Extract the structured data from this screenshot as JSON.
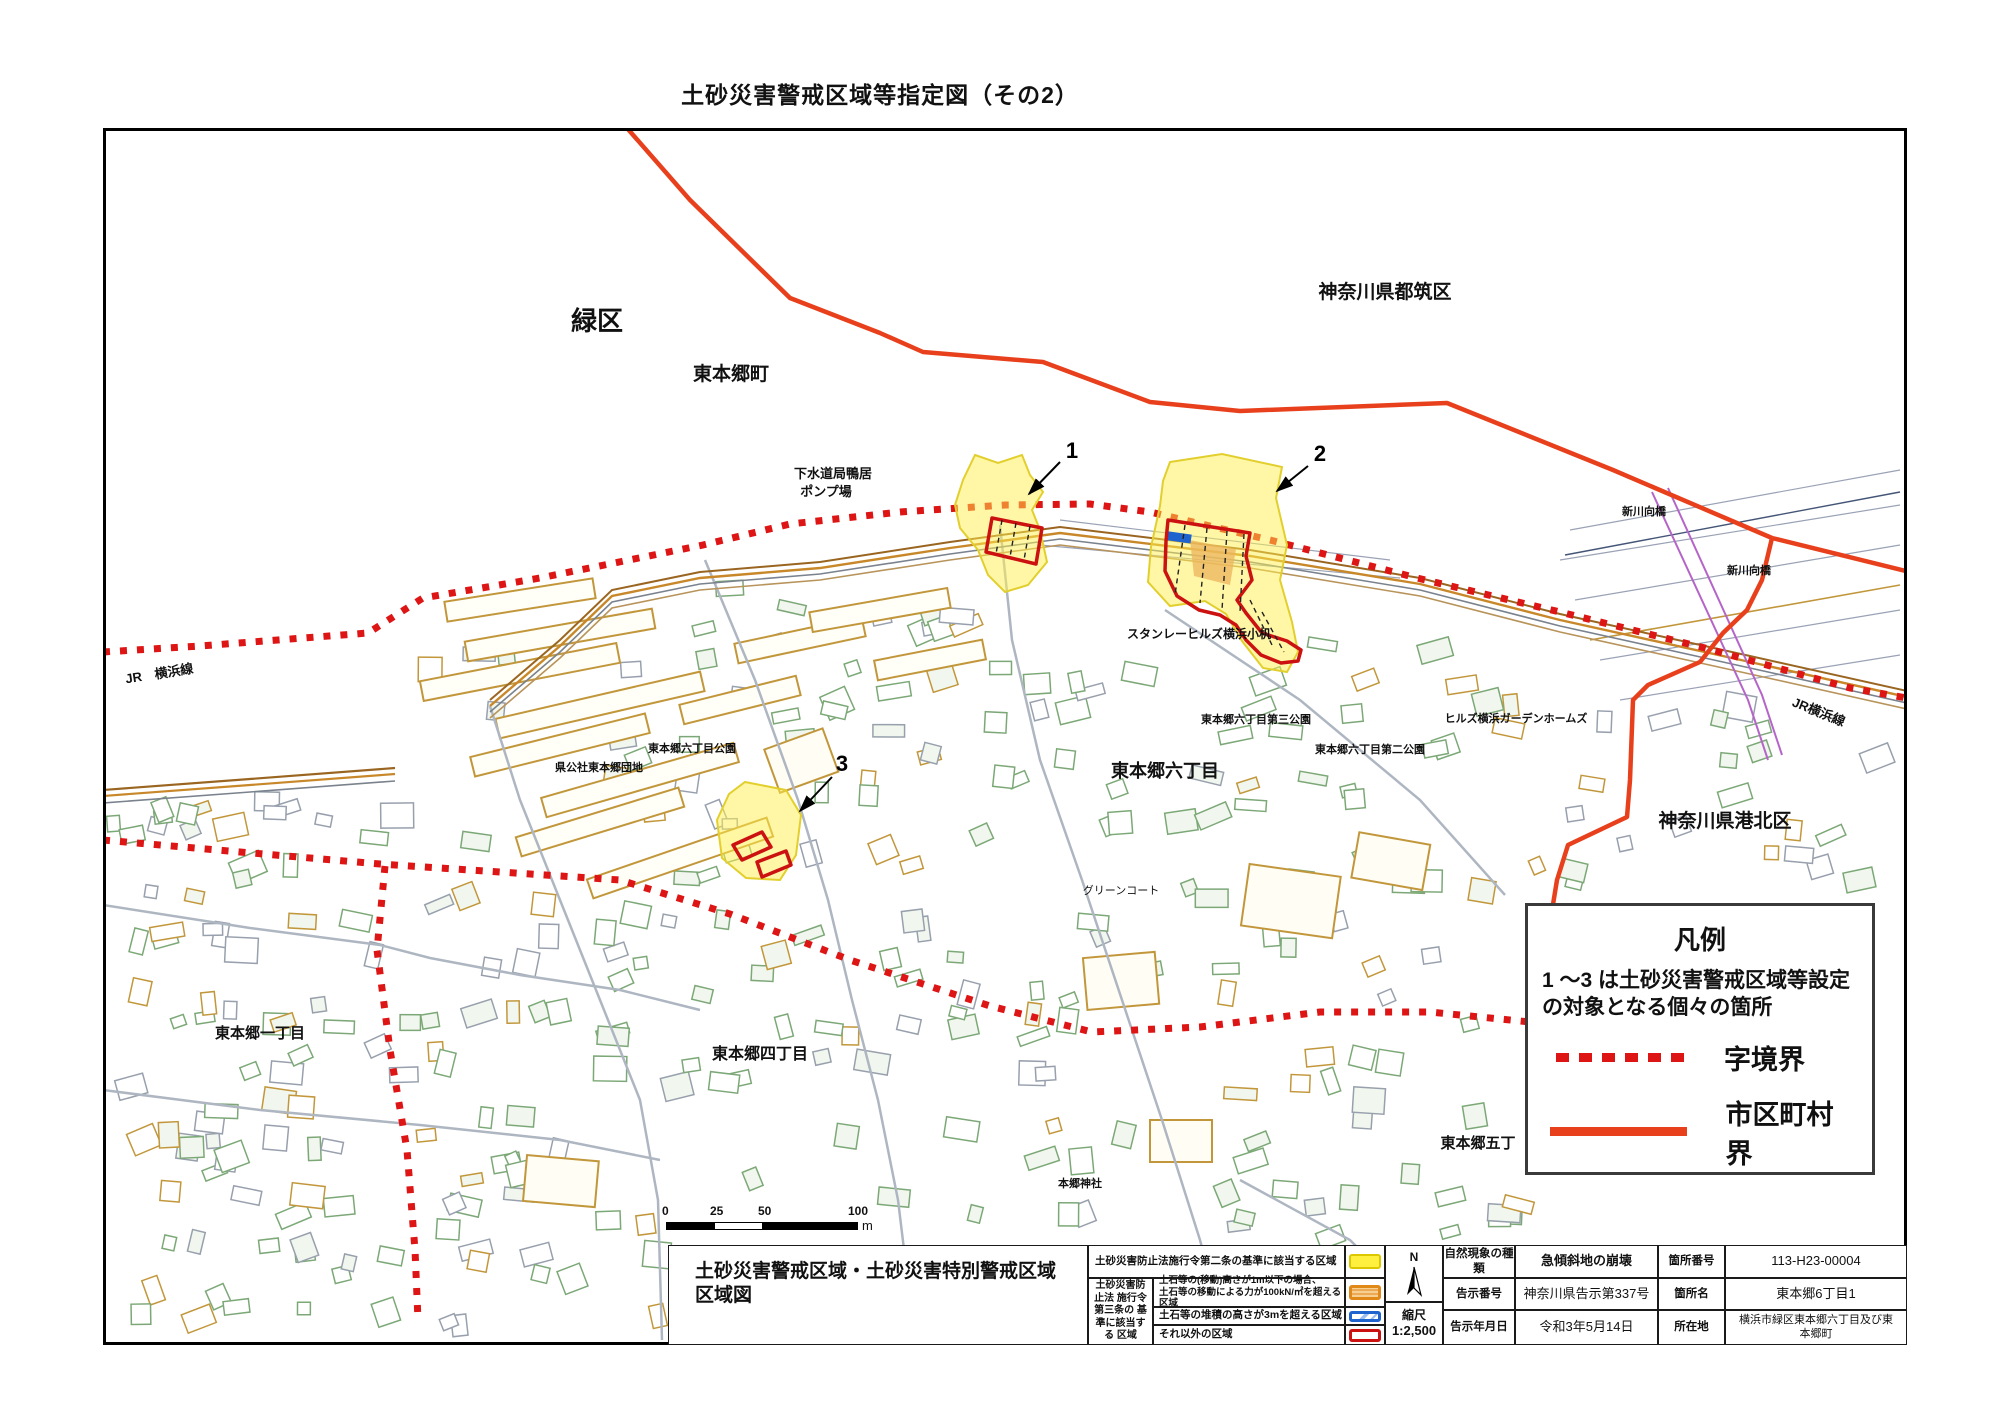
{
  "page": {
    "title": "土砂災害警戒区域等指定図（その2）"
  },
  "colors": {
    "boundary_solid": "#e8401c",
    "boundary_dashed": "#dd1515",
    "zone_yellow": "#fff04d",
    "zone_red": "#cc1111",
    "zone_blue": "#1f63cf",
    "zone_orange": "#e08818"
  },
  "map": {
    "labels": [
      {
        "t": "緑区",
        "x": 597,
        "y": 330,
        "s": 26,
        "b": 1
      },
      {
        "t": "東本郷町",
        "x": 731,
        "y": 380,
        "s": 19,
        "b": 1
      },
      {
        "t": "神奈川県都筑区",
        "x": 1385,
        "y": 298,
        "s": 19,
        "b": 1
      },
      {
        "t": "下水道局鴨居",
        "x": 833,
        "y": 478,
        "s": 13,
        "b": 1
      },
      {
        "t": "ポンプ場",
        "x": 826,
        "y": 496,
        "s": 13,
        "b": 1
      },
      {
        "t": "スタンレーヒルズ横浜小机",
        "x": 1199,
        "y": 638,
        "s": 12,
        "b": 1
      },
      {
        "t": "東本郷六丁目第三公園",
        "x": 1256,
        "y": 723,
        "s": 11,
        "b": 1
      },
      {
        "t": "ヒルズ横浜ガーデンホームズ",
        "x": 1516,
        "y": 722,
        "s": 11,
        "b": 1
      },
      {
        "t": "東本郷六丁目第二公園",
        "x": 1370,
        "y": 753,
        "s": 11,
        "b": 1
      },
      {
        "t": "県公社東本郷団地",
        "x": 599,
        "y": 771,
        "s": 11,
        "b": 1
      },
      {
        "t": "東本郷六丁目公園",
        "x": 692,
        "y": 752,
        "s": 11,
        "b": 1
      },
      {
        "t": "東本郷六丁目",
        "x": 1165,
        "y": 777,
        "s": 18,
        "b": 1
      },
      {
        "t": "神奈川県港北区",
        "x": 1725,
        "y": 827,
        "s": 19,
        "b": 1
      },
      {
        "t": "グリーンコート",
        "x": 1121,
        "y": 894,
        "s": 11,
        "b": 0
      },
      {
        "t": "東本郷一丁目",
        "x": 260,
        "y": 1038,
        "s": 15,
        "b": 1
      },
      {
        "t": "東本郷四丁目",
        "x": 760,
        "y": 1059,
        "s": 16,
        "b": 1
      },
      {
        "t": "東本郷五丁",
        "x": 1478,
        "y": 1148,
        "s": 15,
        "b": 1
      },
      {
        "t": "本郷神社",
        "x": 1080,
        "y": 1187,
        "s": 11,
        "b": 1
      },
      {
        "t": "JR　横浜線",
        "x": 160,
        "y": 678,
        "s": 13,
        "b": 1,
        "r": -9
      },
      {
        "t": "JR横浜線",
        "x": 1817,
        "y": 716,
        "s": 13,
        "b": 1,
        "r": 22
      },
      {
        "t": "新川向橋",
        "x": 1644,
        "y": 515,
        "s": 11,
        "b": 1
      },
      {
        "t": "新川向橋",
        "x": 1749,
        "y": 574,
        "s": 11,
        "b": 1
      }
    ],
    "markers": [
      {
        "n": "1",
        "x": 1072,
        "y": 458,
        "a": [
          1060,
          462,
          1029,
          494
        ]
      },
      {
        "n": "2",
        "x": 1320,
        "y": 461,
        "a": [
          1308,
          466,
          1277,
          491
        ]
      },
      {
        "n": "3",
        "x": 842,
        "y": 771,
        "a": [
          832,
          777,
          800,
          811
        ]
      }
    ]
  },
  "legend_box": {
    "title": "凡例",
    "note": "1 ～3 は土砂災害警戒区域等設定の対象となる個々の箇所",
    "items": [
      {
        "symbol": "red-dashed-line",
        "label": "字境界"
      },
      {
        "symbol": "red-solid-line",
        "label": "市区町村界"
      }
    ]
  },
  "scale_bar": {
    "ticks": [
      "0",
      "25",
      "50",
      "100"
    ],
    "unit": "m"
  },
  "title_block": {
    "map_title_line1": "土砂災害警戒区域・土砂災害特別警戒区域",
    "map_title_line2": "区域図",
    "zone_legend": {
      "row1_label": "土砂災害防止法施行令第二条の基準に該当する区域",
      "group_label": "土砂災害防止法 施行令第三条の 基準に該当する 区域",
      "row2_label_l1": "土石等の(移動)高さが1m以下の場合、",
      "row2_label_l2": "土石等の移動による力が100kN/㎡を超える区域",
      "row3_label": "土石等の堆積の高さが3mを超える区域",
      "row4_label": "それ以外の区域"
    },
    "north_label": "N",
    "scale_label": "縮尺",
    "scale_value": "1:2,500",
    "info": {
      "r1c1": "自然現象の種類",
      "r1c2": "急傾斜地の崩壊",
      "r1c3": "箇所番号",
      "r1c4": "113-H23-00004",
      "r2c1": "告示番号",
      "r2c2": "神奈川県告示第337号",
      "r2c3": "箇所名",
      "r2c4": "東本郷6丁目1",
      "r3c1": "告示年月日",
      "r3c2": "令和3年5月14日",
      "r3c3": "所在地",
      "r3c4": "横浜市緑区東本郷六丁目及び東本郷町"
    }
  }
}
